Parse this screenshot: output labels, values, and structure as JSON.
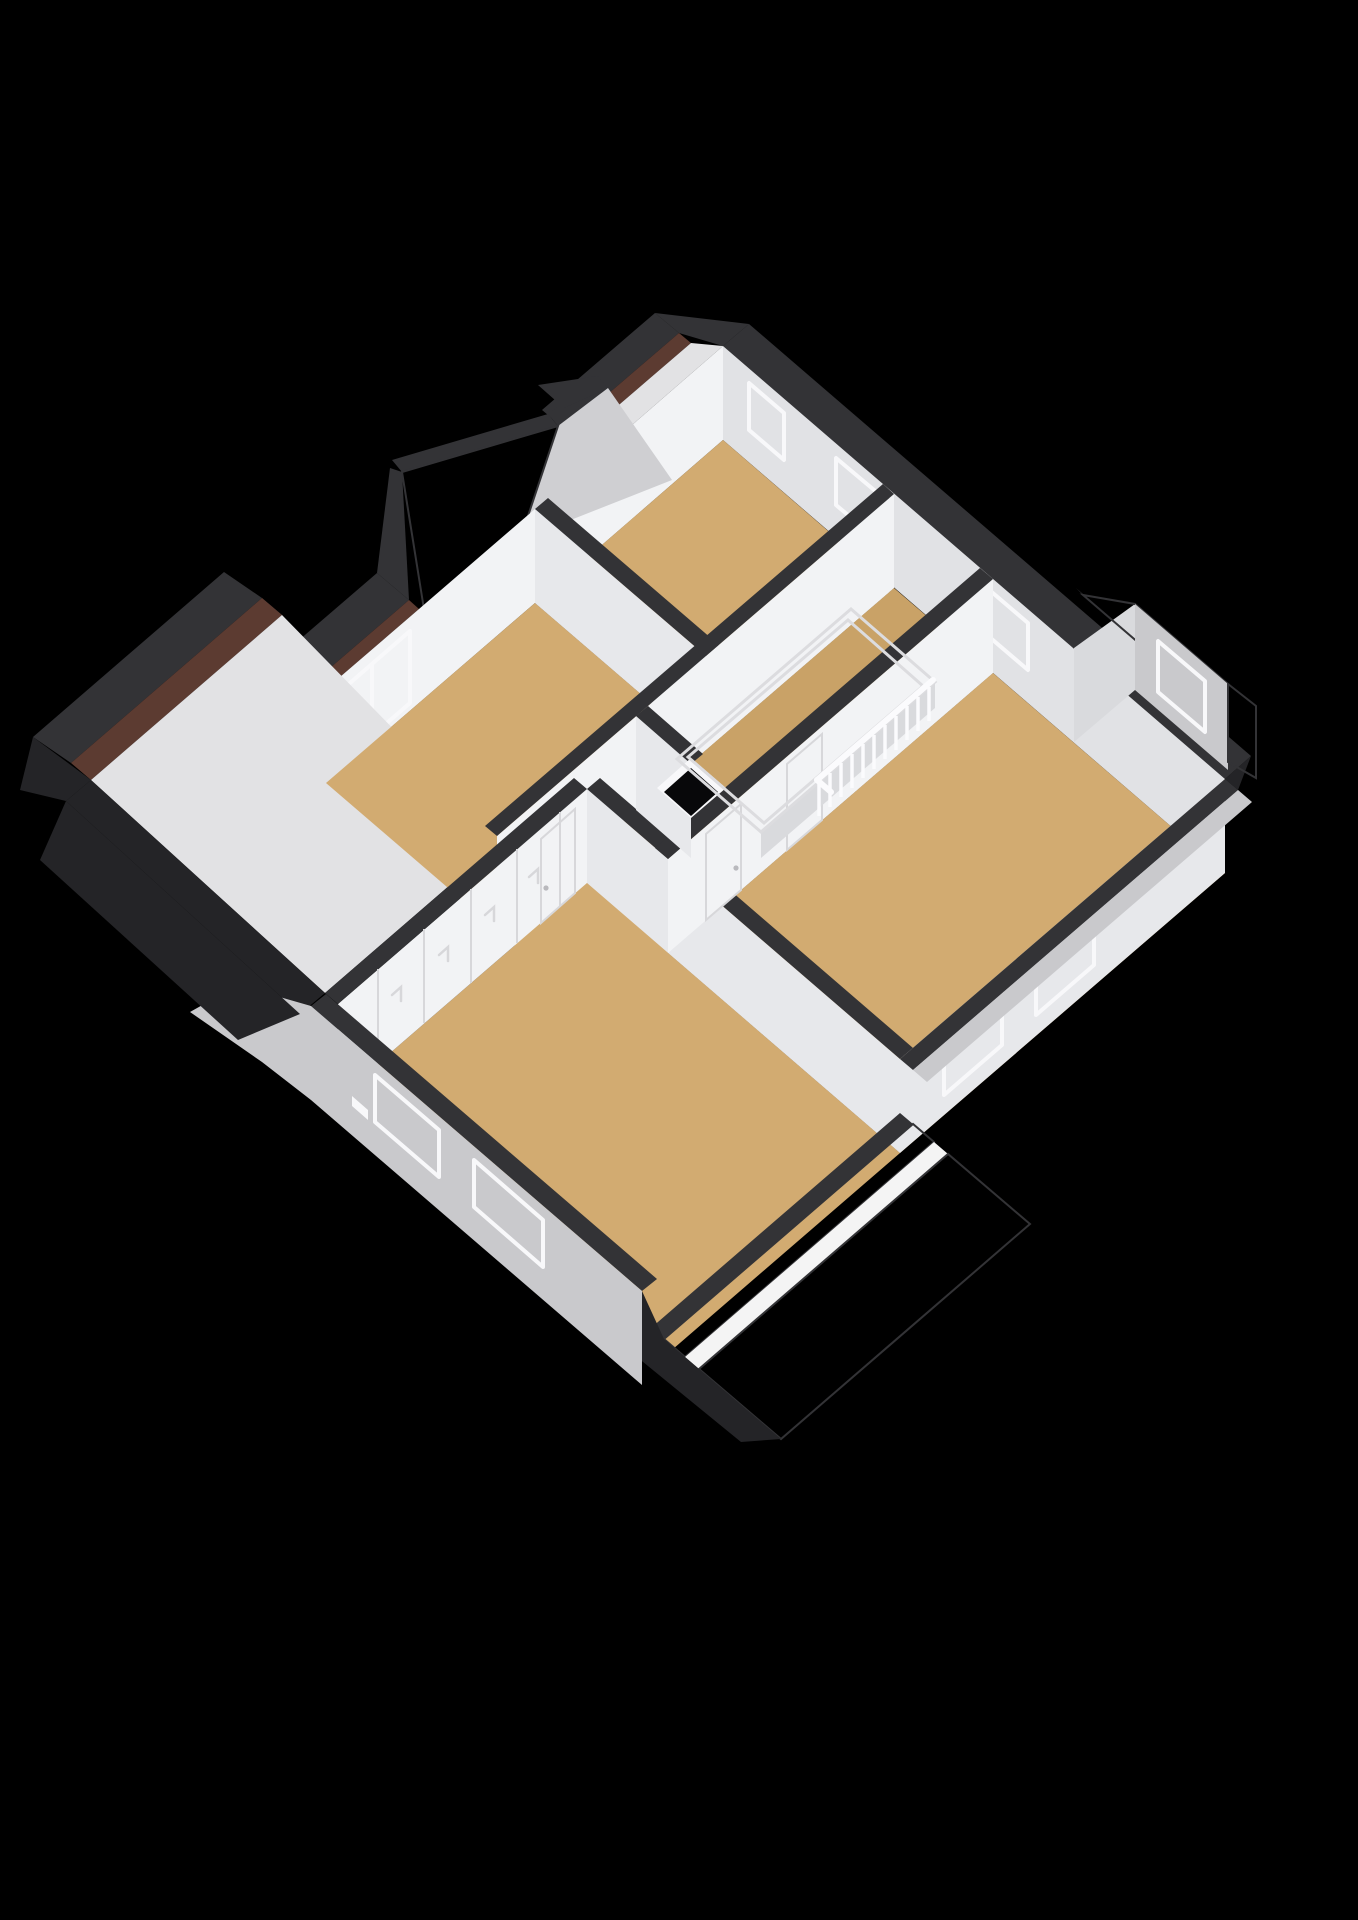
{
  "scene": {
    "type": "3d-floorplan-render",
    "view": "isometric bird's-eye cutaway",
    "subject": "upper floor of a house with pitched roof and dormers",
    "background": "black",
    "visible_text": "none"
  },
  "palette": {
    "background": "#000000",
    "roof_cut_dark": "#333336",
    "roof_band_darker": "#242427",
    "wall_face_bright": "#f2f3f5",
    "wall_face_mid": "#e7e8eb",
    "wall_face_shaded": "#d9dadd",
    "wall_face_ne": "#e1e2e5",
    "exterior_wall": "#c9c9cc",
    "gable_wall": "#cfcfd2",
    "roof_slope_interior": "#e2e2e4",
    "floor_tan": "#d2ab71",
    "floor_tan_dark": "#c9a267",
    "brick_tile": "#a9705a",
    "brick_tile_dark": "#96604b",
    "brick_line": "#5a3a2c",
    "brick_strip": "#5c3b31",
    "fascia_white": "#f4f4f4",
    "glass_dark": "#08080a",
    "glass_tinted": "#45454b",
    "frame_white": "#f8f8fa",
    "railing_white": "#fbfbfd",
    "platform_white": "#f6f6f8",
    "platform_border": "#dcdcdf",
    "panel_line": "#d7d7da"
  },
  "rooms": [
    {
      "name": "master-bedroom",
      "position": "bottom-left",
      "floor": "tan",
      "features": [
        "wardrobe-wall-5-doors",
        "door",
        "2-exterior-windows",
        "roof-dormer-opening"
      ]
    },
    {
      "name": "bedroom-top",
      "position": "top-center",
      "floor": "tan",
      "features": [
        "2-pane-window",
        "brick-roof-slope"
      ]
    },
    {
      "name": "bedroom-2",
      "position": "top-right",
      "floor": "tan",
      "features": [
        "2-black-windows"
      ]
    },
    {
      "name": "bedroom-1",
      "position": "right",
      "floor": "tan",
      "features": [
        "2-doors",
        "roof-dormer-window",
        "2-interior-windows"
      ]
    },
    {
      "name": "landing",
      "position": "center",
      "floor": "tan",
      "features": [
        "stair-railing",
        "stair-bulkhead-platform",
        "floor-void",
        "window"
      ]
    }
  ],
  "exterior_features": [
    "dark cut roof bands around perimeter",
    "thin dark brick strips along cut roof edges",
    "large brick-tiled dormer roof slope at bottom with white fascia and ridge tile row",
    "brick-tiled dormer with black window on right side",
    "grey gable wall with brick slope at top",
    "light grey exterior walls bottom-left and bottom-right with white framed windows"
  ],
  "counts": {
    "black_windows_ne_side": 3,
    "closet_doors": 5,
    "interior_doors": 3,
    "railing_balusters": 11
  }
}
